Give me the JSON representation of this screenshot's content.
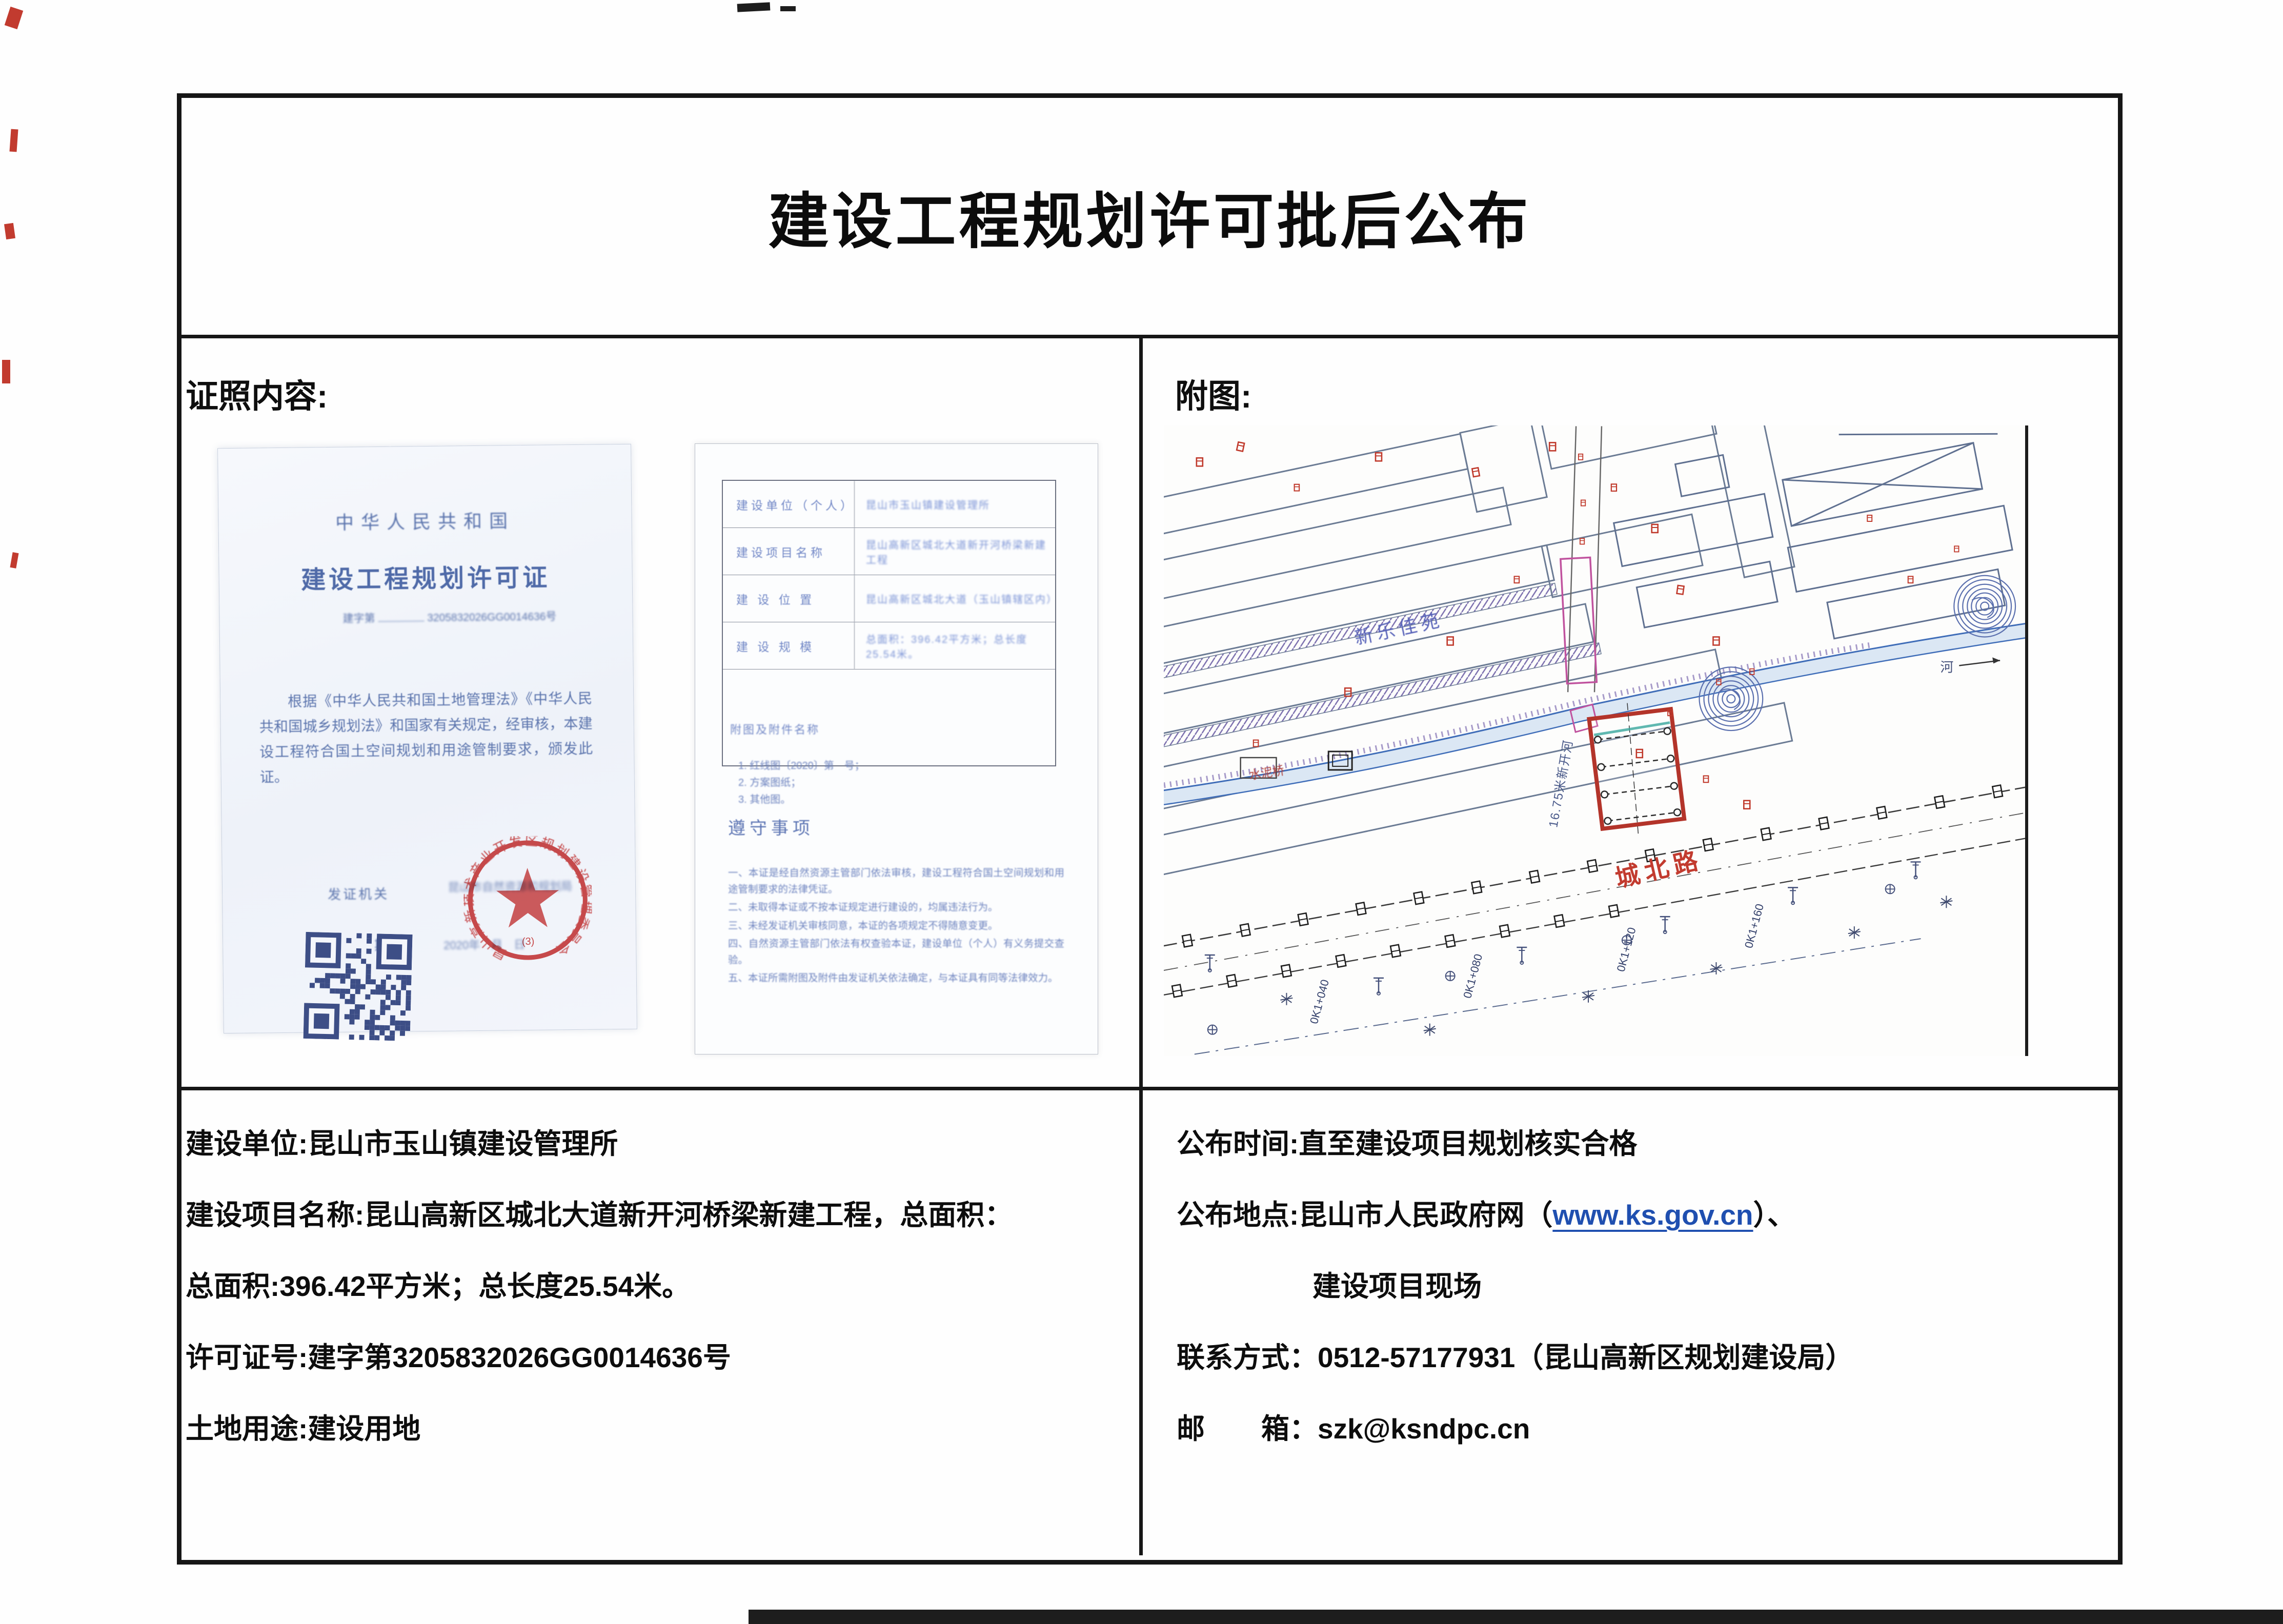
{
  "page": {
    "title": "建设工程规划许可批后公布",
    "left_section_header": "证照内容:",
    "right_section_header": "附图:"
  },
  "license": {
    "country": "中华人民共和国",
    "title": "建设工程规划许可证",
    "number_label": "建字第",
    "number": "3205832026GG0014636号",
    "body": "根据《中华人民共和国土地管理法》《中华人民共和国城乡规划法》和国家有关规定，经审核，本建设工程符合国土空间规划和用途管制要求，颁发此证。",
    "issuer_label": "发证机关",
    "issuer_value": "昆山市自然资源和规划局",
    "date_label": "日　　期",
    "date_value": "2020年　月　日",
    "stamp_ring_text": "昆山高新技术产业开发区规划建设管理委员会",
    "stamp_sub": "(3)"
  },
  "permit_form": {
    "rows": [
      {
        "label": "建设单位（个人）",
        "value": "昆山市玉山镇建设管理所"
      },
      {
        "label": "建设项目名称",
        "value": "昆山高新区城北大道新开河桥梁新建工程"
      },
      {
        "label": "建 设 位 置",
        "value": "昆山高新区城北大道（玉山镇辖区内）"
      },
      {
        "label": "建 设 规 模",
        "value": "总面积：396.42平方米；总长度25.54米。"
      }
    ],
    "attachments_header": "附图及附件名称",
    "attachments": [
      "1. 红线图〔2020〕第　号；",
      "2. 方案图纸；",
      "3. 其他图。"
    ],
    "compliance_header": "遵守事项",
    "compliance_items": [
      "一、本证是经自然资源主管部门依法审核，建设工程符合国土空间规划和用途管制要求的法律凭证。",
      "二、未取得本证或不按本证规定进行建设的，均属违法行为。",
      "三、未经发证机关审核同意，本证的各项规定不得随意变更。",
      "四、自然资源主管部门依法有权查验本证，建设单位（个人）有义务提交查验。",
      "五、本证所需附图及附件由发证机关依法确定，与本证具有同等法律效力。"
    ]
  },
  "map": {
    "road_label": "城北路",
    "residential_label": "新乐佳苑",
    "river_label": "16.75米新开河",
    "bridge_label": "水泥桥",
    "river_char": "河",
    "chainage": [
      "0K1+040",
      "0K1+080",
      "0K1+120",
      "0K1+160"
    ]
  },
  "info_left": {
    "lines": [
      "建设单位:昆山市玉山镇建设管理所",
      "建设项目名称:昆山高新区城北大道新开河桥梁新建工程，总面积：",
      "总面积:396.42平方米；总长度25.54米。",
      "许可证号:建字第3205832026GG0014636号",
      "土地用途:建设用地"
    ]
  },
  "info_right": {
    "publish_time": "公布时间:直至建设项目规划核实合格",
    "publish_place_pre": "公布地点:昆山市人民政府网（",
    "publish_place_link": "www.ks.gov.cn",
    "publish_place_post": "）、",
    "publish_place_line2": "建设项目现场",
    "contact": "联系方式：0512-57177931（昆山高新区规划建设局）",
    "email": "邮　　箱：szk@ksndpc.cn"
  },
  "colors": {
    "site_outline_red": "#b3342a",
    "road_label_red": "#c23b2f",
    "link_blue": "#1f4fb0",
    "stamp_red": "#cc3333",
    "blueprint_blue": "#5b74ad"
  }
}
